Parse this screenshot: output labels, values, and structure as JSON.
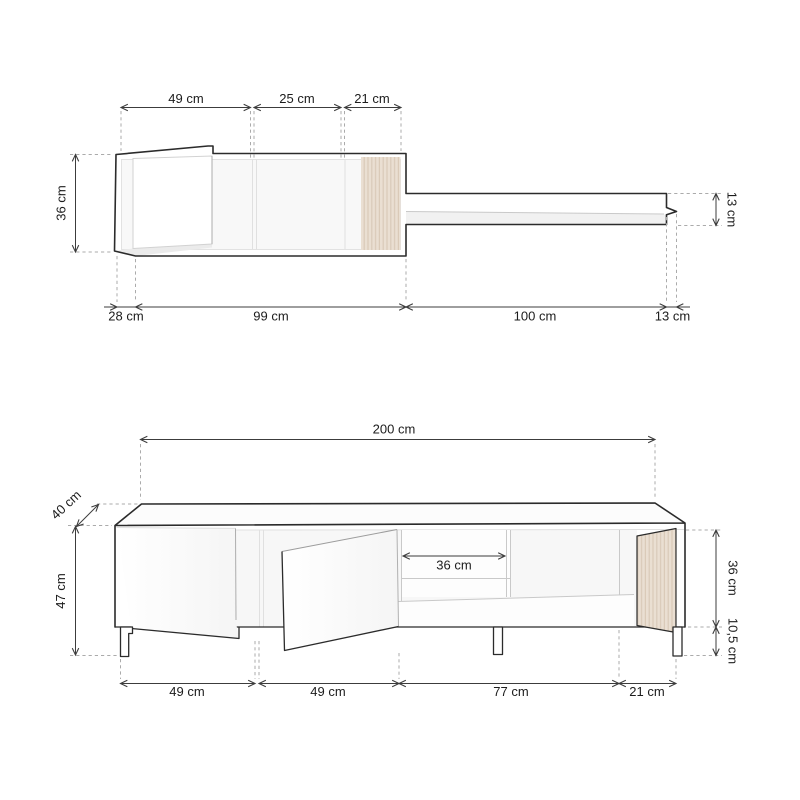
{
  "page": {
    "background": "#ffffff"
  },
  "top_view": {
    "title": "wall-unit-top-view",
    "dim_top_1": "49 cm",
    "dim_top_2": "25 cm",
    "dim_top_3": "21 cm",
    "dim_left": "36 cm",
    "dim_right": "13 cm",
    "dim_bottom_1": "28 cm",
    "dim_bottom_2": "99 cm",
    "dim_bottom_3": "100 cm",
    "dim_bottom_4": "13 cm"
  },
  "front_view": {
    "title": "tv-cabinet-front-view",
    "dim_width": "200 cm",
    "dim_depth": "40 cm",
    "dim_height": "47 cm",
    "dim_shelf": "36 cm",
    "dim_body_height": "36 cm",
    "dim_leg_height": "10,5 cm",
    "dim_bottom_1": "49 cm",
    "dim_bottom_2": "49 cm",
    "dim_bottom_3": "77 cm",
    "dim_bottom_4": "21 cm"
  },
  "colors": {
    "outline": "#2b2b2b",
    "dimension_line": "#3c3c3c",
    "dashed_line": "#ababab",
    "inner_line": "#e0e0e0",
    "slat_fill": "#eadfd2",
    "slat_line": "#d9c9b8",
    "text": "#1c1c1c",
    "background": "#ffffff"
  },
  "unit": "cm"
}
